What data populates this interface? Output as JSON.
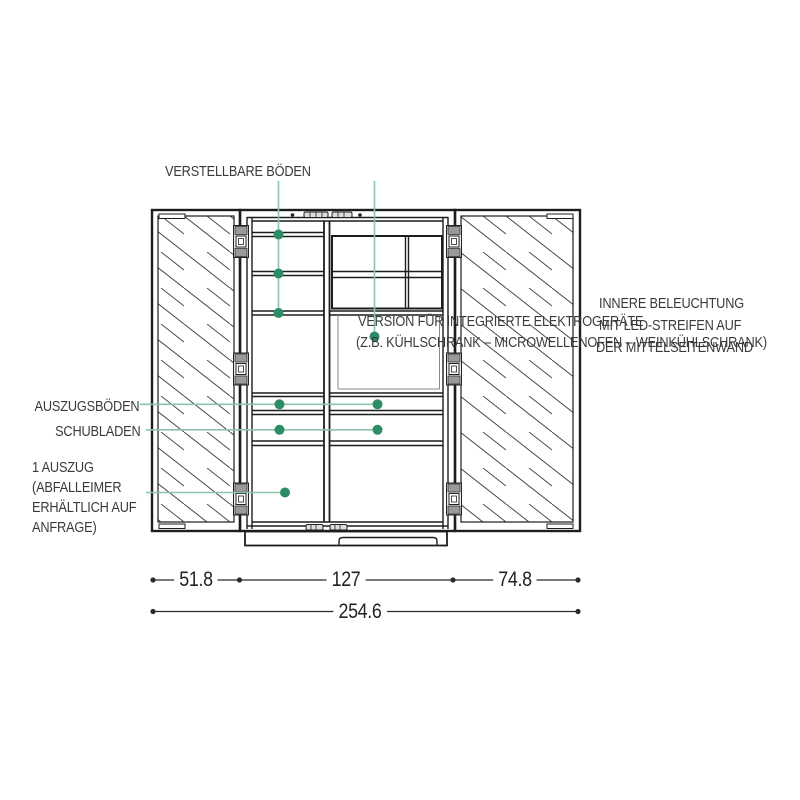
{
  "colors": {
    "ink": "#1d1d1b",
    "faint_line": "#8a8a8a",
    "callout_dot": "#2b8c66",
    "callout_line": "#8cc3ac",
    "text": "#383b3d",
    "background": "#ffffff"
  },
  "annotations": {
    "adjustable_shelves": "VERSTELLBARE BÖDEN",
    "appliance_version": {
      "line1": "VERSION FÜR INTEGRIERTE ELEKTROGERÄTE",
      "line2": "(Z.B. KÜHLSCHRANK – MICROWELLENOFEN – WEINKÜHLSCHRANK)"
    },
    "inner_lighting": {
      "line1": "INNERE BELEUCHTUNG",
      "line2": "MIT LED-STREIFEN AUF",
      "line3": "DER MITTELSEITENWAND"
    },
    "pullout_shelves": "AUSZUGSBÖDEN",
    "drawers": "SCHUBLADEN",
    "waste_pullout": {
      "line1": "1 AUSZUG",
      "line2": "(ABFALLEIMER",
      "line3": "ERHÄLTLICH AUF",
      "line4": "ANFRAGE)"
    }
  },
  "dimensions": {
    "unit_widths": [
      {
        "name": "left-door-width",
        "value": "51.8"
      },
      {
        "name": "center-cabinet-width",
        "value": "127"
      },
      {
        "name": "right-door-width",
        "value": "74.8"
      }
    ],
    "total_width": "254.6"
  }
}
